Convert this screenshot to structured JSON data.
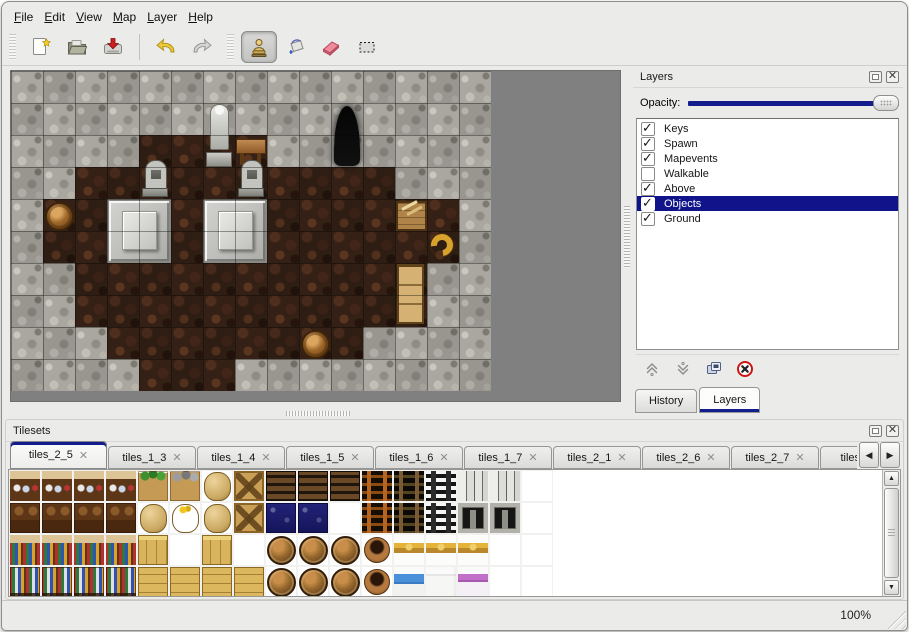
{
  "menubar": {
    "items": [
      "File",
      "Edit",
      "View",
      "Map",
      "Layer",
      "Help"
    ]
  },
  "toolbar": {
    "active_tool": "stamp",
    "buttons": [
      {
        "name": "new",
        "icon": "new-file-icon"
      },
      {
        "name": "open",
        "icon": "open-folder-icon"
      },
      {
        "name": "save",
        "icon": "save-icon"
      },
      {
        "name": "undo",
        "icon": "undo-arrow-icon"
      },
      {
        "name": "redo",
        "icon": "redo-arrow-icon"
      },
      {
        "name": "stamp",
        "icon": "stamp-tool-icon"
      },
      {
        "name": "fill",
        "icon": "paint-bucket-icon"
      },
      {
        "name": "eraser",
        "icon": "eraser-icon"
      },
      {
        "name": "selection",
        "icon": "selection-marquee-icon"
      }
    ]
  },
  "layers_panel": {
    "title": "Layers",
    "opacity_label": "Opacity:",
    "opacity_percent": 100,
    "layers": [
      {
        "label": "Keys",
        "checked": true,
        "selected": false
      },
      {
        "label": "Spawn",
        "checked": true,
        "selected": false
      },
      {
        "label": "Mapevents",
        "checked": true,
        "selected": false
      },
      {
        "label": "Walkable",
        "checked": false,
        "selected": false
      },
      {
        "label": "Above",
        "checked": true,
        "selected": false
      },
      {
        "label": "Objects",
        "checked": true,
        "selected": true
      },
      {
        "label": "Ground",
        "checked": true,
        "selected": false
      }
    ],
    "tabs": [
      {
        "label": "History",
        "active": false
      },
      {
        "label": "Layers",
        "active": true
      }
    ]
  },
  "tilesets_panel": {
    "title": "Tilesets",
    "tabs": [
      {
        "label": "tiles_2_5",
        "active": true
      },
      {
        "label": "tiles_1_3",
        "active": false
      },
      {
        "label": "tiles_1_4",
        "active": false
      },
      {
        "label": "tiles_1_5",
        "active": false
      },
      {
        "label": "tiles_1_6",
        "active": false
      },
      {
        "label": "tiles_1_7",
        "active": false
      },
      {
        "label": "tiles_2_1",
        "active": false
      },
      {
        "label": "tiles_2_6",
        "active": false
      },
      {
        "label": "tiles_2_7",
        "active": false
      },
      {
        "label": "tiles_2",
        "active": false
      }
    ]
  },
  "statusbar": {
    "zoom": "100%"
  },
  "icons": {
    "close": "✕",
    "prev": "◀",
    "next": "▶",
    "up": "▲",
    "down": "▼"
  },
  "colors": {
    "accent_navy": "#141d8c",
    "selection_navy": "#10138a",
    "map_empty_gray": "#808080",
    "wall_stone": "#a9a79f",
    "floor_brown": "#2e1d13"
  },
  "map": {
    "tile_size": 32,
    "grid": [
      "WWWWWWWWWWWWWWW",
      "WWWWWWWWWWWWWWW",
      "WWWWFFFFWWWWWWW",
      "WWFFFFFFFFFFWWW",
      "WFFFFFFFFFFFFFW",
      "WFFFFFFFFFFFFFW",
      "WWFFFFFFFFFFFWW",
      "WWFFFFFFFFFFFWW",
      "WWWFFFFFFFFWWWW",
      "WWWWFFFWWWWWWWW"
    ],
    "legend": {
      "W": "stone-wall",
      "F": "dirt-floor"
    },
    "objects": [
      {
        "type": "statue",
        "name": "statue",
        "x": 6,
        "y": 1,
        "w": 1,
        "h": 2
      },
      {
        "type": "table",
        "name": "wooden-table",
        "x": 7,
        "y": 2,
        "w": 1,
        "h": 1
      },
      {
        "type": "cave-entrance",
        "name": "cave-entrance",
        "x": 10,
        "y": 1,
        "w": 1,
        "h": 2
      },
      {
        "type": "tombstone",
        "name": "tombstone",
        "x": 4,
        "y": 3,
        "w": 1,
        "h": 1
      },
      {
        "type": "tombstone",
        "name": "tombstone",
        "x": 7,
        "y": 3,
        "w": 1,
        "h": 1
      },
      {
        "type": "altar",
        "name": "altar-platform",
        "x": 3,
        "y": 4,
        "w": 2,
        "h": 2
      },
      {
        "type": "altar",
        "name": "altar-platform",
        "x": 6,
        "y": 4,
        "w": 2,
        "h": 2
      },
      {
        "type": "barrel",
        "name": "barrel",
        "x": 1,
        "y": 4,
        "w": 1,
        "h": 1
      },
      {
        "type": "crate",
        "name": "crate-shelf",
        "x": 12,
        "y": 4,
        "w": 1,
        "h": 1
      },
      {
        "type": "horn",
        "name": "gold-horn",
        "x": 13,
        "y": 5,
        "w": 1,
        "h": 1
      },
      {
        "type": "dresser",
        "name": "wooden-cabinet",
        "x": 12,
        "y": 6,
        "w": 1,
        "h": 2
      },
      {
        "type": "barrel",
        "name": "barrel",
        "x": 9,
        "y": 8,
        "w": 1,
        "h": 1
      }
    ]
  },
  "tileset_grid": {
    "rows": [
      "ccccpgkxdddlLMaa.",
      "CCCCkKkxnn.lLMDD.",
      "bbbby.y.ooouhhh..",
      "BBBBYYYYooouvwq.."
    ],
    "legend": {
      "c": "cupboard-top",
      "C": "cupboard-bottom",
      "b": "bookshelf-top",
      "B": "bookshelf-bottom",
      "p": "plant-crate",
      "g": "stone-crate",
      "k": "sack",
      "K": "open-sack",
      "x": "crossed-crate",
      "n": "navy-crate",
      "d": "dark-planks",
      "l": "ladder-orange",
      "L": "ladder-brown",
      "M": "ladder-black",
      "a": "arch-pillars",
      "D": "stone-doorway",
      "y": "yellow-crate",
      "Y": "yellow-crate-long",
      "o": "barrel",
      "u": "clay-pot",
      "h": "bed-headboard",
      "v": "bed-blue",
      "w": "bed-white",
      "q": "bed-purple",
      ".": "empty-cell"
    }
  }
}
